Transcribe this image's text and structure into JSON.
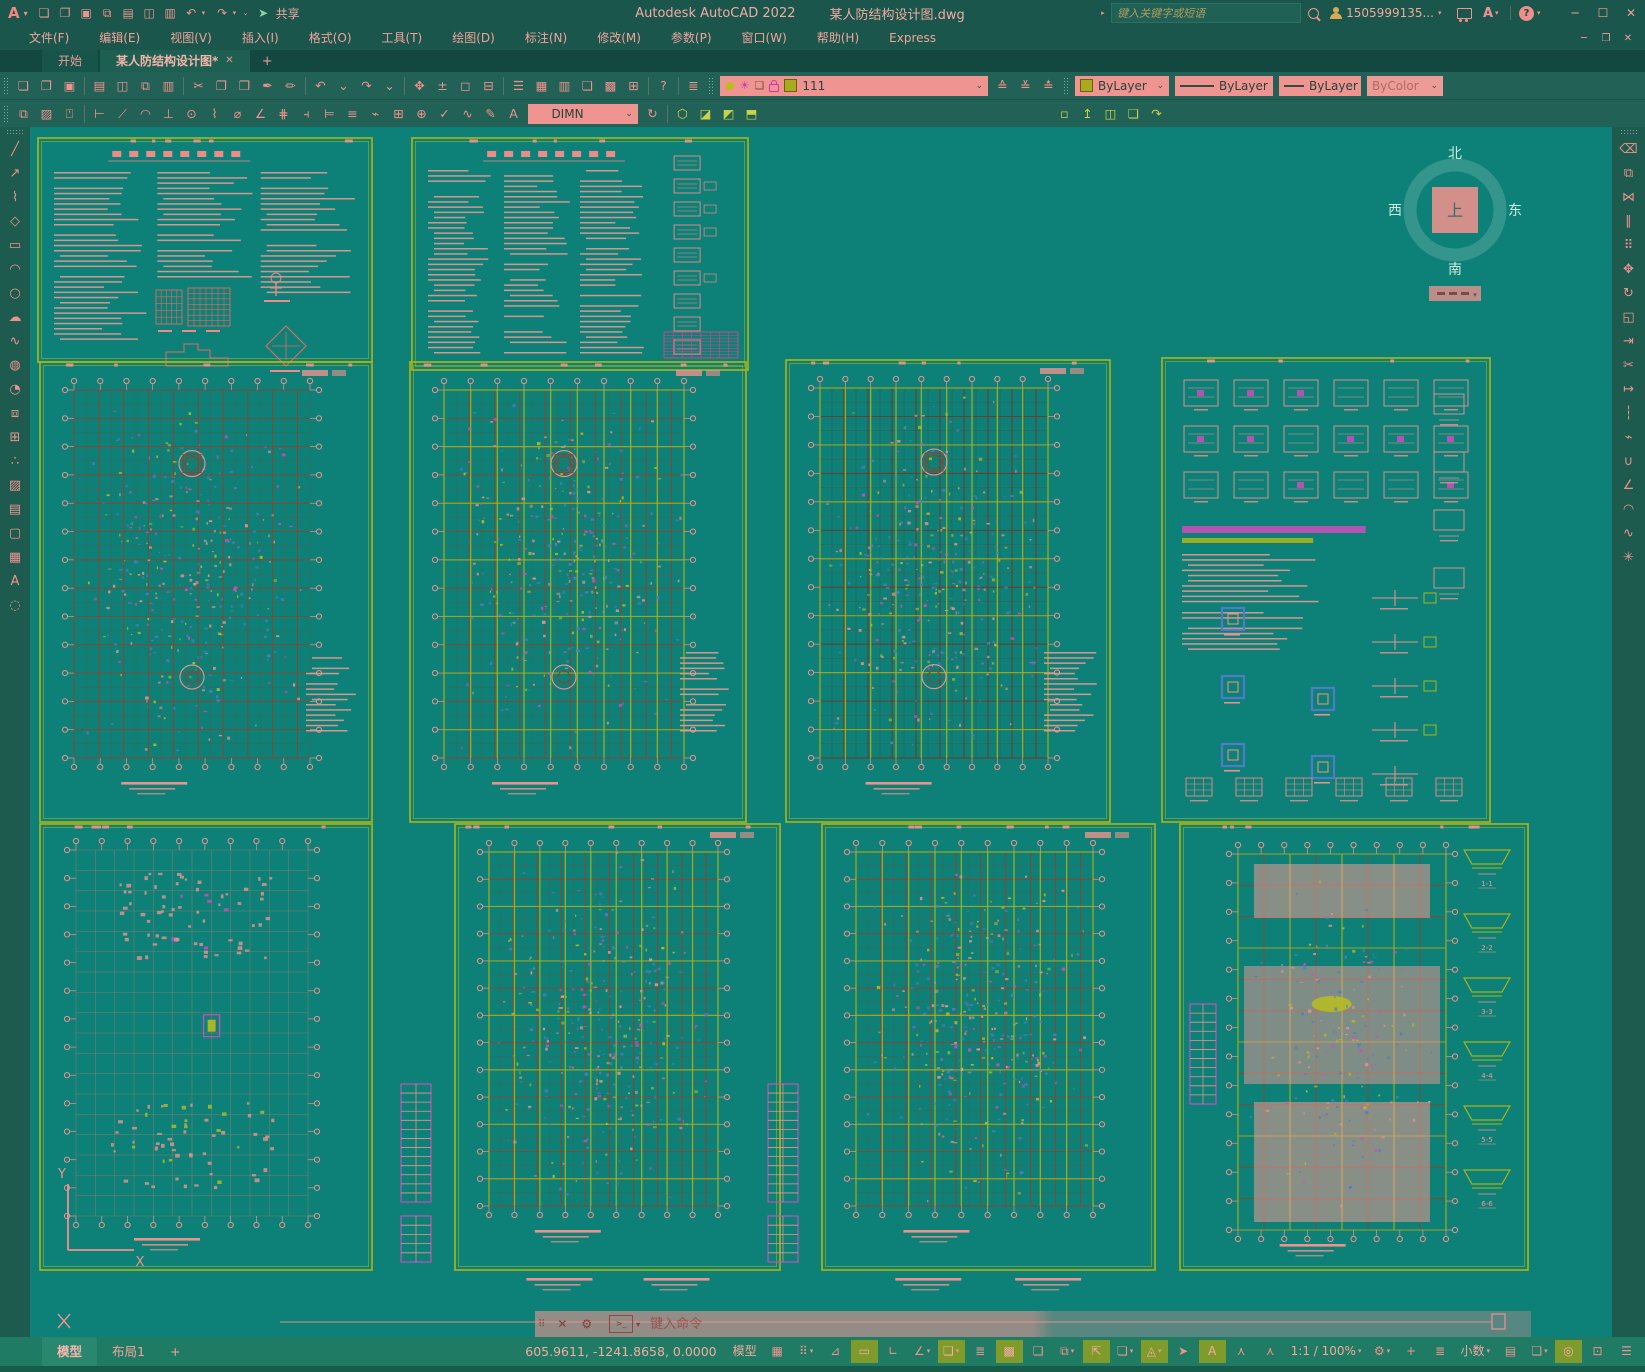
{
  "colors": {
    "canvas": "#0d8177",
    "chrome": "#1a564b",
    "tabrow": "#134840",
    "toolbar": "#226156",
    "statusbar": "#1f7b63",
    "salmon": "#ee928e",
    "salmon_bright": "#f6b3ab",
    "chartreuse": "#a6b31a",
    "olive_active": "#7f9b2b",
    "brown": "#93402a",
    "brown_dark": "#7e2f20",
    "blue": "#4d7cc8",
    "magenta": "#d14cc0",
    "yellow": "#b9bd1f",
    "compass_ring": "rgba(190,225,218,0.22)",
    "compass_text": "#cfe8e0"
  },
  "titlebar": {
    "app_menu": "A",
    "app_title": "Autodesk AutoCAD 2022",
    "doc_title": "某人防结构设计图.dwg",
    "share": "共享",
    "search_placeholder": "键入关键字或短语",
    "search_expander": "▸",
    "user": "1505999135...",
    "store": "A",
    "help": "?",
    "quick_access": [
      [
        "qnew-icon",
        "❏"
      ],
      [
        "open-icon",
        "❐"
      ],
      [
        "save-icon",
        "▣"
      ],
      [
        "save-as-icon",
        "⧉"
      ],
      [
        "plot-icon",
        "▤"
      ],
      [
        "plot-preview-icon",
        "◫"
      ],
      [
        "print-icon",
        "▥"
      ]
    ],
    "undo_glyph": "↶",
    "redo_glyph": "↷",
    "customize_glyph": "⌄",
    "share_glyph": "➤",
    "win_buttons": [
      [
        "minimize-button",
        "─"
      ],
      [
        "maximize-button",
        "☐"
      ],
      [
        "close-button",
        "✕"
      ]
    ]
  },
  "menubar": {
    "items": [
      "文件(F)",
      "编辑(E)",
      "视图(V)",
      "插入(I)",
      "格式(O)",
      "工具(T)",
      "绘图(D)",
      "标注(N)",
      "修改(M)",
      "参数(P)",
      "窗口(W)",
      "帮助(H)",
      "Express"
    ],
    "doc_buttons": [
      [
        "doc-minimize-button",
        "─"
      ],
      [
        "doc-restore-button",
        "❐"
      ],
      [
        "doc-close-button",
        "✕"
      ]
    ]
  },
  "doc_tabs": {
    "start": "开始",
    "active": "某人防结构设计图*",
    "close_glyph": "✕",
    "new_glyph": "+"
  },
  "toolbar1": {
    "icons": [
      [
        "qnew-icon",
        "❏"
      ],
      [
        "open-icon",
        "❐"
      ],
      [
        "save-icon",
        "▣"
      ],
      [
        "sep",
        ""
      ],
      [
        "plot-icon",
        "▤"
      ],
      [
        "plot-preview-icon",
        "◫"
      ],
      [
        "publish-icon",
        "⧉"
      ],
      [
        "3dprint-icon",
        "▥"
      ],
      [
        "sep",
        ""
      ],
      [
        "cut-icon",
        "✂"
      ],
      [
        "copy-clip-icon",
        "❐"
      ],
      [
        "paste-icon",
        "❒"
      ],
      [
        "match-properties-icon",
        "✒"
      ],
      [
        "block-editor-icon",
        "✏"
      ],
      [
        "sep",
        ""
      ],
      [
        "undo-icon",
        "↶"
      ],
      [
        "undo-chevron",
        "⌄"
      ],
      [
        "redo-icon",
        "↷"
      ],
      [
        "redo-chevron",
        "⌄"
      ],
      [
        "sep",
        ""
      ],
      [
        "pan-icon",
        "✥"
      ],
      [
        "zoom-realtime-icon",
        "±"
      ],
      [
        "zoom-window-icon",
        "◻"
      ],
      [
        "zoom-previous-icon",
        "⊟"
      ],
      [
        "sep",
        ""
      ],
      [
        "properties-icon",
        "☰"
      ],
      [
        "designcenter-icon",
        "▦"
      ],
      [
        "tool-palettes-icon",
        "▥"
      ],
      [
        "sheet-set-icon",
        "❏"
      ],
      [
        "markup-icon",
        "▩"
      ],
      [
        "quickcalc-icon",
        "⊞"
      ],
      [
        "sep",
        ""
      ],
      [
        "help-icon",
        "?"
      ],
      [
        "sep",
        ""
      ],
      [
        "layer-properties-icon",
        "≣"
      ]
    ],
    "layer_dropdown": {
      "value": "111",
      "bulb_glyph": "●",
      "sun_glyph": "☀",
      "frame_glyph": "❏"
    },
    "layer_tools": [
      [
        "make-current-layer-icon",
        "≙"
      ],
      [
        "layer-previous-icon",
        "≚"
      ],
      [
        "layer-translate-icon",
        "≛"
      ]
    ],
    "color_dropdown": "ByLayer",
    "linetype_dropdown": "ByLayer",
    "lineweight_dropdown": "ByLayer",
    "plotstyle_dropdown": "ByColor"
  },
  "toolbar2": {
    "group1": [
      [
        "draworder-icon",
        "⧉"
      ],
      [
        "hatch-tool-icon",
        "▨"
      ],
      [
        "annotate-front-icon",
        "⍞"
      ]
    ],
    "dim_icons": [
      [
        "linear-dim-icon",
        "⊢"
      ],
      [
        "aligned-dim-icon",
        "⟋"
      ],
      [
        "arc-length-icon",
        "◠"
      ],
      [
        "ordinate-dim-icon",
        "⊥"
      ],
      [
        "radius-dim-icon",
        "⊙"
      ],
      [
        "jogged-dim-icon",
        "⌇"
      ],
      [
        "diameter-dim-icon",
        "⌀"
      ],
      [
        "angular-dim-icon",
        "∠"
      ],
      [
        "quick-dim-icon",
        "⋕"
      ],
      [
        "baseline-dim-icon",
        "⫞"
      ],
      [
        "continue-dim-icon",
        "⊨"
      ],
      [
        "dim-space-icon",
        "≡"
      ],
      [
        "dim-break-icon",
        "⌁"
      ],
      [
        "tolerance-icon",
        "⊞"
      ],
      [
        "center-mark-icon",
        "⊕"
      ],
      [
        "dim-inspect-icon",
        "✓"
      ],
      [
        "dim-jogline-icon",
        "∿"
      ],
      [
        "dim-edit-icon",
        "✎"
      ],
      [
        "dim-text-edit-icon",
        "A"
      ]
    ],
    "dimstyle_dropdown": "DIMN",
    "dim_update_glyph": "↻",
    "group3": [
      [
        "union-icon",
        "⬡"
      ],
      [
        "subtract-icon",
        "◪"
      ],
      [
        "intersect-icon",
        "◩"
      ],
      [
        "extrude-icon",
        "⬒"
      ]
    ],
    "group4": [
      [
        "box-icon",
        "▫"
      ],
      [
        "polysolid-icon",
        "↥"
      ],
      [
        "planesurf-icon",
        "◫"
      ],
      [
        "slice-icon",
        "❏"
      ],
      [
        "3dalign-icon",
        "↷"
      ]
    ]
  },
  "draw_toolbar": [
    [
      "line-icon",
      "╱"
    ],
    [
      "construction-line-icon",
      "↗"
    ],
    [
      "polyline-icon",
      "⌇"
    ],
    [
      "polygon-icon",
      "◇"
    ],
    [
      "rectangle-icon",
      "▭"
    ],
    [
      "arc-icon",
      "◠"
    ],
    [
      "circle-icon",
      "○"
    ],
    [
      "revcloud-icon",
      "☁"
    ],
    [
      "spline-icon",
      "∿"
    ],
    [
      "ellipse-icon",
      "◍"
    ],
    [
      "ellipse-arc-icon",
      "◔"
    ],
    [
      "insert-block-icon",
      "⧈"
    ],
    [
      "make-block-icon",
      "⊞"
    ],
    [
      "point-icon",
      "∴"
    ],
    [
      "hatch-icon",
      "▨"
    ],
    [
      "gradient-icon",
      "▤"
    ],
    [
      "region-icon",
      "▢"
    ],
    [
      "table-icon",
      "▦"
    ],
    [
      "mtext-icon",
      "A"
    ],
    [
      "point-style-icon",
      "◌"
    ]
  ],
  "modify_toolbar": [
    [
      "erase-icon",
      "⌫"
    ],
    [
      "copy-icon",
      "⧉"
    ],
    [
      "mirror-icon",
      "⋈"
    ],
    [
      "offset-icon",
      "∥"
    ],
    [
      "array-icon",
      "⠿"
    ],
    [
      "move-icon",
      "✥"
    ],
    [
      "rotate-icon",
      "↻"
    ],
    [
      "scale-icon",
      "◱"
    ],
    [
      "stretch-icon",
      "⇥"
    ],
    [
      "trim-icon",
      "✂"
    ],
    [
      "extend-icon",
      "↦"
    ],
    [
      "break-at-point-icon",
      "┆"
    ],
    [
      "break-icon",
      "⌁"
    ],
    [
      "join-icon",
      "∪"
    ],
    [
      "chamfer-icon",
      "∠"
    ],
    [
      "fillet-icon",
      "◠"
    ],
    [
      "blend-icon",
      "∿"
    ],
    [
      "explode-icon",
      "✳"
    ]
  ],
  "canvas": {
    "compass": {
      "north": "北",
      "south": "南",
      "west": "西",
      "east": "东",
      "center": "上"
    },
    "ucs": {
      "x_label": "X",
      "y_label": "Y"
    },
    "section_labels": [
      "1-1",
      "2-2",
      "3-3",
      "4-4",
      "5-5",
      "6-6"
    ],
    "sheets": [
      {
        "id": "notes-1",
        "type": "notes",
        "x": 8,
        "y": 12,
        "w": 334,
        "h": 224,
        "seed": 11,
        "variant": 1
      },
      {
        "id": "notes-2",
        "type": "notes",
        "x": 382,
        "y": 12,
        "w": 336,
        "h": 232,
        "seed": 22,
        "variant": 2
      },
      {
        "id": "plan-m1",
        "type": "plan",
        "x": 10,
        "y": 236,
        "w": 332,
        "h": 460,
        "seed": 33,
        "yellow": false,
        "rings": true,
        "sideNotes": true
      },
      {
        "id": "plan-m2",
        "type": "plan",
        "x": 380,
        "y": 236,
        "w": 336,
        "h": 460,
        "seed": 44,
        "yellow": true,
        "rings": true,
        "sideNotes": true
      },
      {
        "id": "plan-m3",
        "type": "plan",
        "x": 756,
        "y": 234,
        "w": 324,
        "h": 462,
        "seed": 55,
        "yellow": true,
        "red": true,
        "rings": true,
        "sideNotes": true
      },
      {
        "id": "details-m4",
        "type": "details",
        "x": 1132,
        "y": 232,
        "w": 328,
        "h": 464,
        "seed": 66
      },
      {
        "id": "plan-b1",
        "type": "sparse",
        "x": 10,
        "y": 698,
        "w": 332,
        "h": 446,
        "seed": 77
      },
      {
        "id": "plan-b2",
        "type": "plan",
        "x": 425,
        "y": 698,
        "w": 325,
        "h": 446,
        "seed": 88,
        "yellow": true,
        "stairsLeft": true,
        "caption": true
      },
      {
        "id": "plan-b3",
        "type": "plan",
        "x": 792,
        "y": 698,
        "w": 333,
        "h": 446,
        "seed": 99,
        "yellow": true,
        "stairsLeft": true,
        "caption": true
      },
      {
        "id": "plan-b4",
        "type": "shaded",
        "x": 1150,
        "y": 698,
        "w": 348,
        "h": 446,
        "seed": 123
      }
    ]
  },
  "command": {
    "placeholder": "键入命令",
    "grip_glyph": "⠿",
    "close_glyph": "✕",
    "tool_glyph": "⚙",
    "prompt_glyph": "&gt;_",
    "chevron": "▾"
  },
  "statusbar": {
    "model_tab": "模型",
    "layout_tab": "布局1",
    "new_layout": "+",
    "coords": "605.9611, -1241.8658, 0.0000",
    "model_button": "模型",
    "toggles": [
      {
        "name": "grid-icon",
        "glyph": "▦",
        "active": false
      },
      {
        "name": "snap-icon",
        "glyph": "⠿",
        "active": false,
        "chev": true
      },
      {
        "name": "infer-constraints-icon",
        "glyph": "⊿",
        "active": false
      },
      {
        "name": "dynamic-input-icon",
        "glyph": "▭",
        "active": true
      },
      {
        "name": "ortho-icon",
        "glyph": "∟",
        "active": false
      },
      {
        "name": "polar-tracking-icon",
        "glyph": "∠",
        "active": false,
        "chev": true
      },
      {
        "name": "isometric-drafting-icon",
        "glyph": "❏",
        "active": true,
        "chev": true
      },
      {
        "name": "object-snap-tracking-icon",
        "glyph": "≣",
        "active": false
      },
      {
        "name": "object-snap-icon",
        "glyph": "▩",
        "active": true
      },
      {
        "name": "transparency-icon",
        "glyph": "❏",
        "active": false
      },
      {
        "name": "selection-cycling-icon",
        "glyph": "⧉",
        "active": false,
        "chev": true
      },
      {
        "name": "3d-osnap-icon",
        "glyph": "⇱",
        "active": true
      },
      {
        "name": "dynamic-ucs-icon",
        "glyph": "❏",
        "active": false,
        "chev": true
      },
      {
        "name": "selection-filter-icon",
        "glyph": "◬",
        "active": true,
        "chev": true
      },
      {
        "name": "gizmo-icon",
        "glyph": "➤",
        "active": false
      },
      {
        "name": "annotation-visibility-icon",
        "glyph": "A",
        "active": true
      },
      {
        "name": "autoscale-icon",
        "glyph": "⋏",
        "active": false
      },
      {
        "name": "annotation-people-icon",
        "glyph": "⋏",
        "active": false
      },
      {
        "name": "annotation-scale",
        "glyph": "1:1 / 100%",
        "active": false,
        "chev": true,
        "text": true
      },
      {
        "name": "status-settings-icon",
        "glyph": "⚙",
        "active": false,
        "chev": true
      },
      {
        "name": "crosshair-icon",
        "glyph": "+",
        "active": false
      },
      {
        "name": "units-list-icon",
        "glyph": "≣",
        "active": false
      },
      {
        "name": "units-value",
        "glyph": "小数",
        "active": false,
        "chev": true,
        "text": true
      },
      {
        "name": "quick-properties-icon",
        "glyph": "▤",
        "active": false
      },
      {
        "name": "lock-ui-icon",
        "glyph": "❏",
        "active": false,
        "chev": true
      },
      {
        "name": "graphics-performance-icon",
        "glyph": "◎",
        "active": true
      },
      {
        "name": "clean-screen-icon",
        "glyph": "⊡",
        "active": false
      },
      {
        "name": "customization-icon",
        "glyph": "☰",
        "active": false
      }
    ]
  }
}
